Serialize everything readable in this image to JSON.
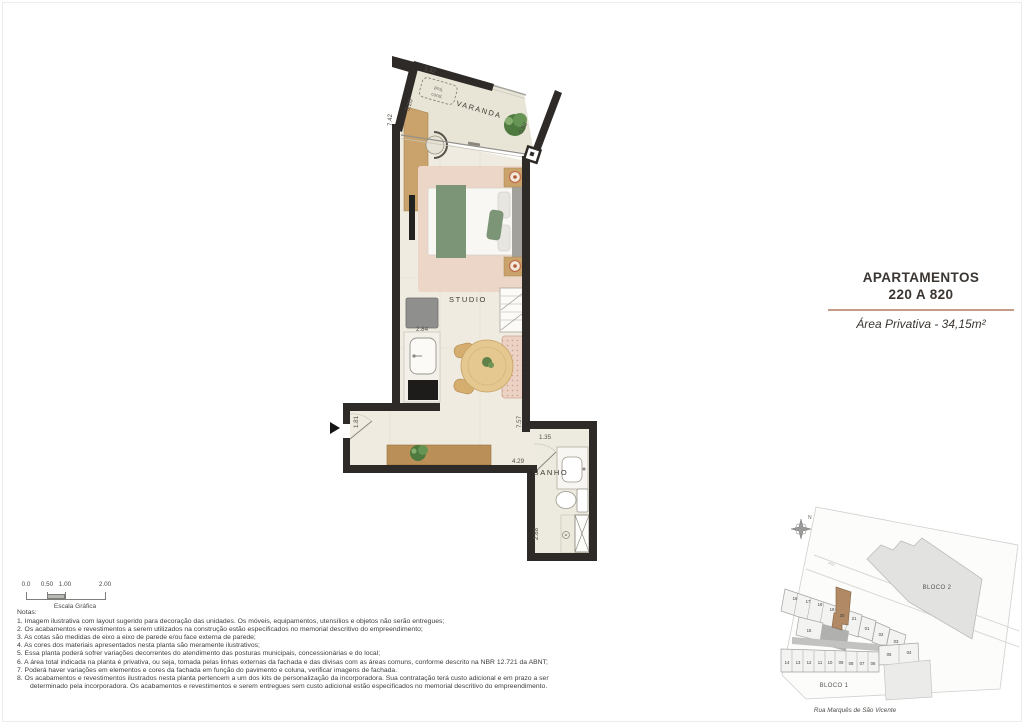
{
  "title_block": {
    "line1": "APARTAMENTOS",
    "line2": "220 A 820",
    "area_label": "Área Privativa - 34,15m²"
  },
  "floor_plan": {
    "room_labels": {
      "varanda": "VARANDA",
      "studio": "STUDIO",
      "banho": "BANHO"
    },
    "proj_cond": {
      "line1": "proj.",
      "line2": "cond."
    },
    "dimensions": {
      "varanda_top": "3.32",
      "varanda_door": "0.93",
      "left_wall_total": "7.42",
      "left_wall_diag": "3.20",
      "kitchen_width": "2.84",
      "entry_side": "1.81",
      "right_wall_total": "7.57",
      "hall_length": "4.29",
      "banho_width": "1.35",
      "banho_depth": "2.88"
    }
  },
  "scale_bar": {
    "ticks": [
      "0.0",
      "0.50",
      "1.00",
      "2.00"
    ],
    "caption": "Escala Gráfica"
  },
  "notes": {
    "heading": "Notas:",
    "items": [
      "1. Imagem ilustrativa com layout sugerido para decoração das unidades. Os móveis, equipamentos, utensílios e objetos não serão entregues;",
      "2. Os acabamentos e revestimentos a serem utilizados na construção estão especificados no memorial descritivo do empreendimento;",
      "3. As cotas são medidas de eixo a eixo de parede e/ou face externa de parede;",
      "4. As cores dos materiais apresentados nesta planta são meramente ilustrativos;",
      "5. Essa planta poderá sofrer variações decorrentes do atendimento das posturas municipais, concessionárias e do local;",
      "6. A área total indicada na planta é privativa, ou seja, tomada pelas linhas externas da fachada e das divisas com as áreas comuns, conforme descrito na NBR 12.721 da ABNT;",
      "7. Poderá haver variações em elementos e cores da fachada em função do pavimento e coluna, verificar imagens de fachada.",
      "8. Os acabamentos e revestimentos ilustrados nesta planta pertencem a um dos kits de personalização da incorporadora. Sua contratação terá custo adicional e em prazo a ser determinado pela incorporadora. Os acabamentos e revestimentos e serem entregues sem custo adicional estão especificados  no memorial descritivo do empreendimento."
    ]
  },
  "site_plan": {
    "north_label": "N",
    "street_tag": "FNA",
    "bloco1_label": "BLOCO 1",
    "bloco2_label": "BLOCO 2",
    "street_name": "Rua Marquês de São Vicente",
    "upper_units": [
      "16",
      "17",
      "18",
      "19",
      "20",
      "21",
      "01",
      "02",
      "03"
    ],
    "unit_15": "15",
    "lower_units": [
      "14",
      "13",
      "12",
      "11",
      "10",
      "09",
      "08",
      "07",
      "06",
      "05",
      "04"
    ],
    "highlighted_unit": "20"
  },
  "colors": {
    "wall": "#2e2a27",
    "floor": "#efebe0",
    "accent_divider": "#c59c86",
    "unit_highlight": "#b18a65"
  }
}
